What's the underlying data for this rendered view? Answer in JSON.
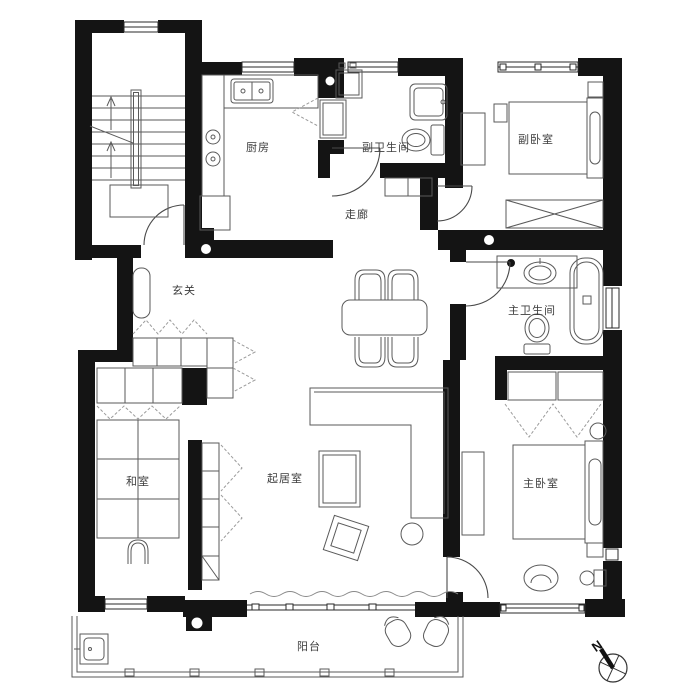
{
  "rooms": {
    "kitchen": {
      "label": "厨房"
    },
    "secondary_bathroom": {
      "label": "副卫生间"
    },
    "secondary_bedroom": {
      "label": "副卧室"
    },
    "corridor": {
      "label": "走廊"
    },
    "entrance_hall": {
      "label": "玄关"
    },
    "main_bathroom": {
      "label": "主卫生间"
    },
    "tatami_room": {
      "label": "和室"
    },
    "living_room": {
      "label": "起居室"
    },
    "master_bedroom": {
      "label": "主卧室"
    },
    "balcony": {
      "label": "阳台"
    }
  },
  "compass": {
    "label": "N"
  },
  "colors": {
    "wall": "#141414",
    "furniture_line": "#5a5a5a",
    "dashed_line": "#9b9b9b",
    "label_text": "#3d3d3d",
    "background": "#ffffff"
  }
}
